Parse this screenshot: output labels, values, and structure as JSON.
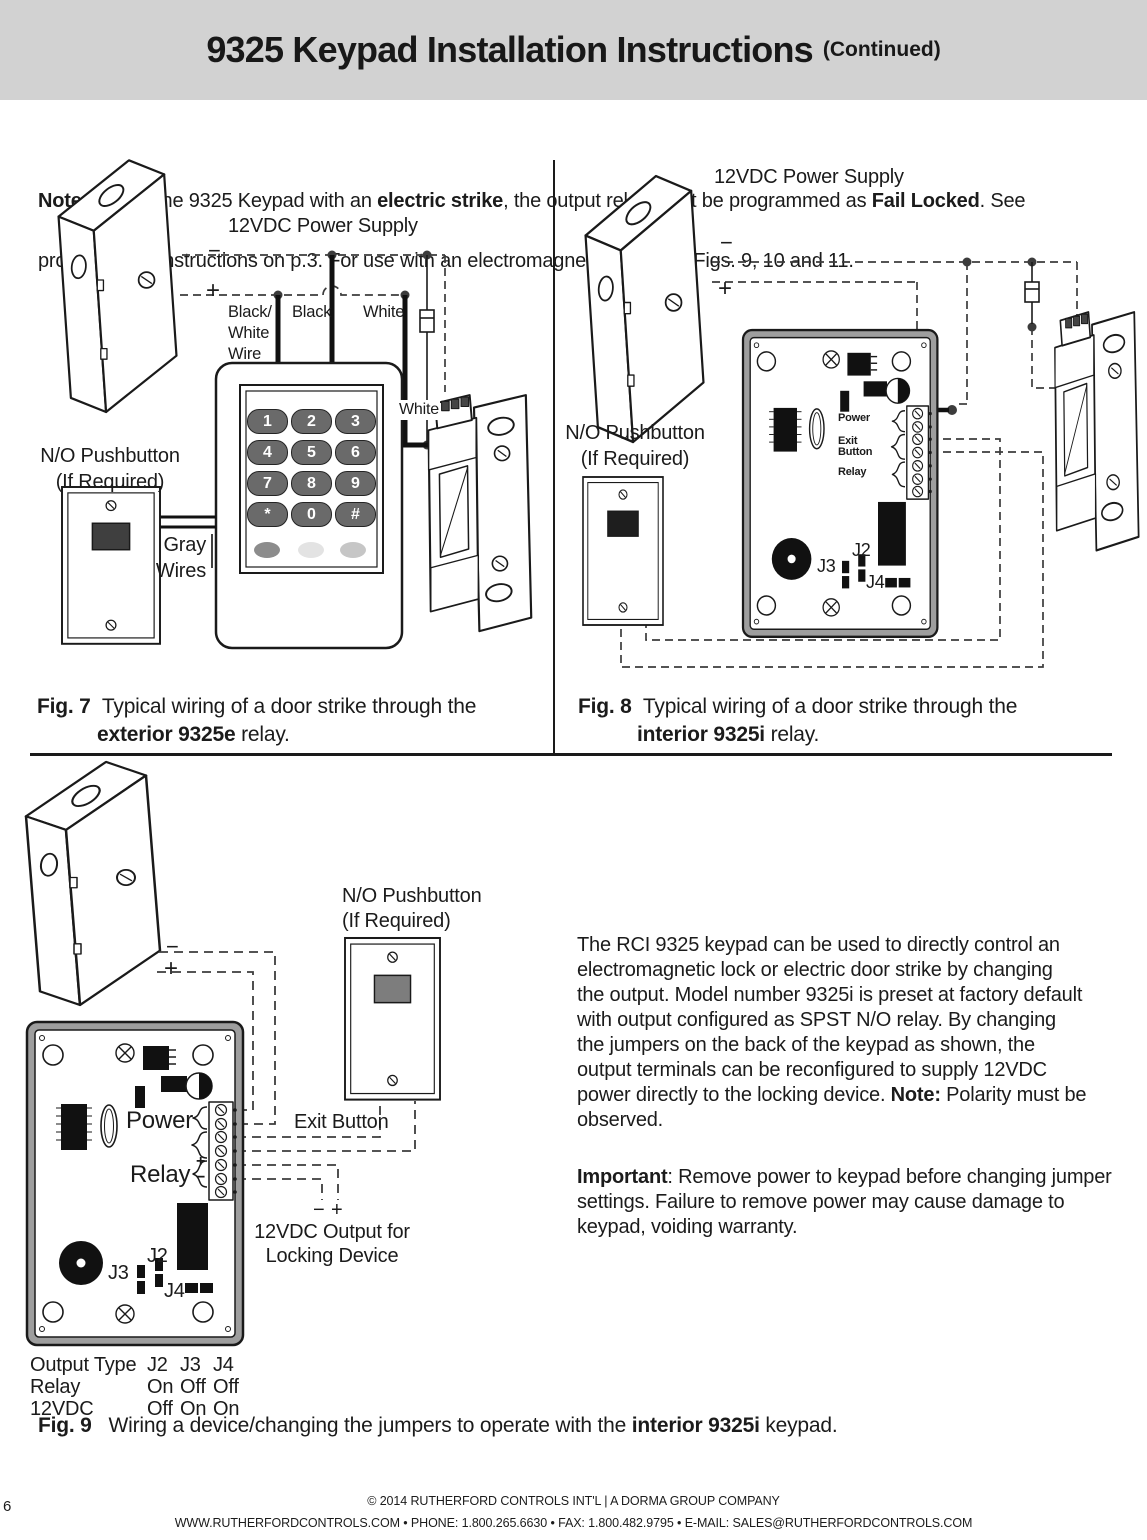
{
  "header": {
    "title": "9325 Keypad Installation Instructions",
    "continued": "(Continued)"
  },
  "note": {
    "label": "Note:",
    "seg1": " To use the 9325 Keypad with an ",
    "bold1": "electric strike",
    "seg2": ", the output relay must be programmed as ",
    "bold2": "Fail Locked",
    "seg3": ". See",
    "line2": "programming instructions on p.3. For use with an electromagnetic lock, see Figs. 9, 10 and 11."
  },
  "fig7": {
    "power_supply": "12VDC Power Supply",
    "minus": "−",
    "plus": "+",
    "wire_bw": "Black/\nWhite\nWire",
    "wire_black": "Black",
    "wire_white": "White",
    "wire_white2": "White",
    "pushbutton": "N/O Pushbutton\n(If Required)",
    "gray_wires": "Gray\nWires",
    "keys": [
      "1",
      "2",
      "3",
      "4",
      "5",
      "6",
      "7",
      "8",
      "9",
      "*",
      "0",
      "#"
    ],
    "led_colors": [
      "#8c8c8c",
      "#e3e3e3",
      "#c6c6c6"
    ],
    "caption_fig": "Fig. 7",
    "caption_text": "Typical wiring of a door strike through the",
    "caption_bold": "exterior 9325e",
    "caption_tail": " relay."
  },
  "fig8": {
    "power_supply": "12VDC Power Supply",
    "minus": "−",
    "plus": "+",
    "pushbutton": "N/O Pushbutton\n(If Required)",
    "pcb": {
      "power": "Power",
      "exit": "Exit\nButton",
      "relay": "Relay",
      "j2": "J2",
      "j3": "J3",
      "j4": "J4"
    },
    "caption_fig": "Fig. 8",
    "caption_text": "Typical wiring of a door strike through the",
    "caption_bold": "interior 9325i",
    "caption_tail": " relay."
  },
  "fig9": {
    "minus": "−",
    "plus": "+",
    "pushbutton": "N/O Pushbutton\n(If Required)",
    "power": "Power",
    "relay": "Relay",
    "relay_plus": "+",
    "relay_minus": "−",
    "exit_button": "Exit Button",
    "j2": "J2",
    "j3": "J3",
    "j4": "J4",
    "out_minus": "−",
    "out_plus": "+",
    "output_label": "12VDC Output for\nLocking Device",
    "table": {
      "header": [
        "Output Type",
        "J2",
        "J3",
        "J4"
      ],
      "rows": [
        [
          "Relay",
          "On",
          "Off",
          "Off"
        ],
        [
          "12VDC",
          "Off",
          "On",
          "On"
        ]
      ]
    },
    "caption_fig": "Fig. 9",
    "caption_pre": "Wiring a device/changing the jumpers to operate with the ",
    "caption_bold": "interior 9325i",
    "caption_tail": " keypad."
  },
  "body": {
    "p1": [
      "The RCI 9325 keypad can be used to directly control an",
      "electromagnetic lock or electric door strike by changing",
      "the output. Model number 9325i is preset at factory default",
      "with output configured as SPST N/O relay. By changing",
      "the jumpers on the back of the keypad as shown, the",
      "output terminals can be reconfigured to supply 12VDC"
    ],
    "p1_last_pre": "power directly to the locking device. ",
    "p1_note": "Note:",
    "p1_last_post": " Polarity must be",
    "p1_end": "observed.",
    "p2_bold": "Important",
    "p2_rest": ": Remove power to keypad before changing jumper",
    "p2_line2": "settings. Failure to remove power may cause damage to",
    "p2_line3": "keypad, voiding warranty."
  },
  "footer": {
    "page": "6",
    "line1": "© 2014 RUTHERFORD CONTROLS INT'L | A DORMA GROUP COMPANY",
    "line2": "WWW.RUTHERFORDCONTROLS.COM • PHONE: 1.800.265.6630 • FAX: 1.800.482.9795 • E-MAIL: SALES@RUTHERFORDCONTROLS.COM"
  }
}
